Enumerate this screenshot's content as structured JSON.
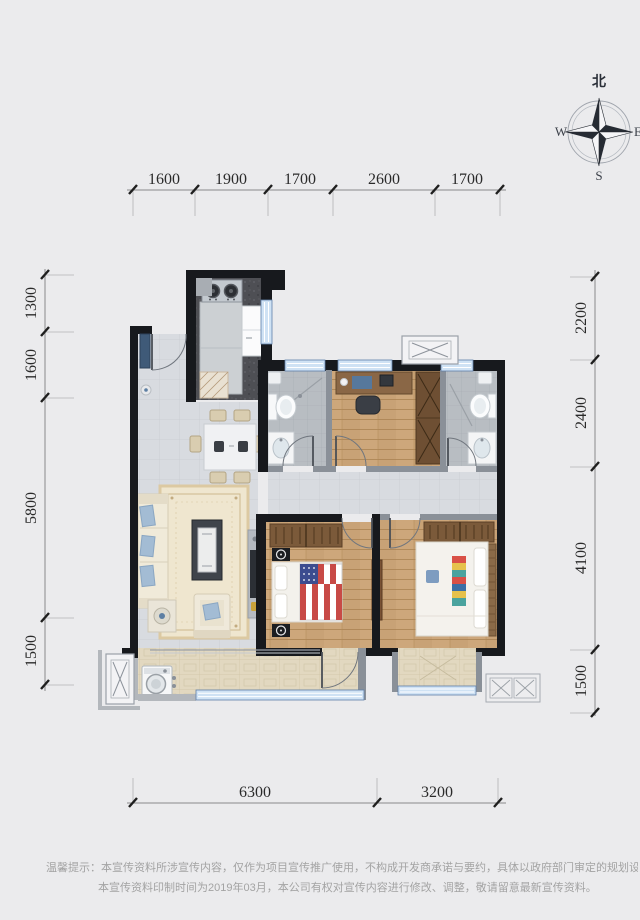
{
  "compass": {
    "north": "北",
    "west": "W",
    "east": "E",
    "south": "S"
  },
  "dimensions": {
    "top": [
      "1600",
      "1900",
      "1700",
      "2600",
      "1700"
    ],
    "left": [
      "1300",
      "1600",
      "5800",
      "1500"
    ],
    "right": [
      "2200",
      "2400",
      "4100",
      "1500"
    ],
    "bottom": [
      "6300",
      "3200"
    ]
  },
  "disclaimer": {
    "line1": "温馨提示：本宣传资料所涉宣传内容，仅作为项目宣传推广使用，不构成开发商承诺与要约，具体以政府部门审定的规划设计文件及商品房买卖合同约",
    "line2": "本宣传资料印制时间为2019年03月，本公司有权对宣传内容进行修改、调整，敬请留意最新宣传资料。"
  },
  "colors": {
    "background": "#ebebed",
    "dim_text": "#2a2a2a",
    "disclaimer_text": "#a3a3a3",
    "wall": "#17191d",
    "wall_gray": "#8a9098",
    "window_blue": "#cfe2f4",
    "window_frame": "#5f7fa8",
    "tile_floor": "#d8dbe0",
    "wood_floor": "#c8a276",
    "bath_floor": "#b8bdc2",
    "balcony_floor": "#e2d8c0",
    "kitchen_floor": "#4e4f54",
    "sofa": "#f0ead9",
    "accent_pillow": "#a3bcd4",
    "wardrobe_brown": "#7b5a3a",
    "flag_red": "#c84a46",
    "flag_blue": "#3c4c8f"
  }
}
